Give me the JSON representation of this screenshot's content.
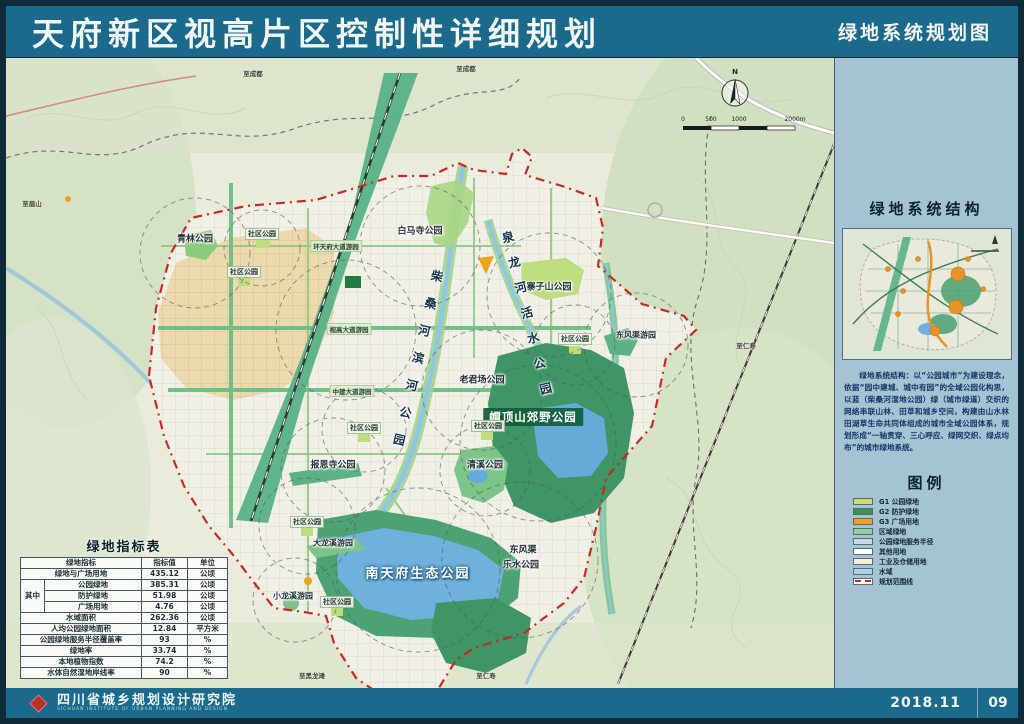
{
  "header": {
    "title": "天府新区视高片区控制性详细规划",
    "subtitle": "绿地系统规划图"
  },
  "map": {
    "compass": "N",
    "scale_ticks": [
      "0",
      "500",
      "1000",
      "2000m"
    ],
    "labels": [
      {
        "text": "青林公园"
      },
      {
        "text": "社区公园"
      },
      {
        "text": "社区公园"
      },
      {
        "text": "白马寺公园"
      },
      {
        "text": "寨子山公园"
      },
      {
        "text": "社区公园"
      },
      {
        "text": "东风渠游园"
      },
      {
        "text": "老君场公园"
      },
      {
        "text": "帽顶山郊野公园"
      },
      {
        "text": "社区公园"
      },
      {
        "text": "社区公园"
      },
      {
        "text": "清溪公园"
      },
      {
        "text": "报恩寺公园"
      },
      {
        "text": "社区公园"
      },
      {
        "text": "大龙溪游园"
      },
      {
        "text": "南天府生态公园"
      },
      {
        "text": "东风渠"
      },
      {
        "text": "乐水公园"
      },
      {
        "text": "小龙溪游园"
      },
      {
        "text": "社区公园"
      },
      {
        "text": "环天府大道游园"
      },
      {
        "text": "视高大道游园"
      },
      {
        "text": "中建大道游园"
      }
    ],
    "vertical_labels": [
      {
        "text": "柴桑河滨河公园"
      },
      {
        "text": "泉龙河活水公园"
      }
    ],
    "edge_labels": [
      {
        "text": "至成都"
      },
      {
        "text": "至成都"
      },
      {
        "text": "至眉山"
      },
      {
        "text": "至仁寿"
      },
      {
        "text": "至黑龙滩"
      },
      {
        "text": "至仁寿"
      }
    ]
  },
  "table": {
    "title": "绿地指标表",
    "headers": [
      "绿地指标",
      "指标值",
      "单位"
    ],
    "group_label": "其中",
    "rows": [
      {
        "name": "绿地与广场用地",
        "value": "435.12",
        "unit": "公顷"
      },
      {
        "name": "公园绿地",
        "value": "385.31",
        "unit": "公顷"
      },
      {
        "name": "防护绿地",
        "value": "51.98",
        "unit": "公顷"
      },
      {
        "name": "广场用地",
        "value": "4.76",
        "unit": "公顷"
      },
      {
        "name": "水域面积",
        "value": "262.36",
        "unit": "公顷"
      },
      {
        "name": "人均公园绿地面积",
        "value": "12.84",
        "unit": "平方米"
      },
      {
        "name": "公园绿地服务半径覆盖率",
        "value": "93",
        "unit": "%"
      },
      {
        "name": "绿地率",
        "value": "33.74",
        "unit": "%"
      },
      {
        "name": "本地植物指数",
        "value": "74.2",
        "unit": "%"
      },
      {
        "name": "水体自然湿地岸线率",
        "value": "90",
        "unit": "%"
      }
    ]
  },
  "panel": {
    "structure_heading": "绿地系统结构",
    "description": "绿地系统结构：以“公园城市”为建设理念，依据“园中建城、城中有园”的全域公园化构思，以蓝（柴桑河湿地公园）绿（城市绿道）交织的网络串联山林、田草和城乡空间，构建由山水林田湖草生命共同体组成的城市全域公园体系，规划形成“一轴贯穿、三心呼应、绿网交织、绿点均布”的城市绿地系统。",
    "legend_heading": "图例",
    "legend": [
      {
        "label": "G1 公园绿地",
        "color": "#c6df6f"
      },
      {
        "label": "G2 防护绿地",
        "color": "#3f9150"
      },
      {
        "label": "G3 广场用地",
        "color": "#f0a11f"
      },
      {
        "label": "区域绿地",
        "color": "#8fd49c"
      },
      {
        "label": "公园绿地服务半径",
        "color": "#c7dbe3"
      },
      {
        "label": "其他用地",
        "color": "#ffffff"
      },
      {
        "label": "工业及仓储用地",
        "color": "#f6f0d9"
      },
      {
        "label": "水域",
        "color": "#a8d3ec"
      },
      {
        "label": "规划范围线",
        "color": "#ffffff"
      }
    ]
  },
  "footer": {
    "org": "四川省城乡规划设计研究院",
    "org_en": "SICHUAN INSTITUTE OF URBAN PLANNING AND DESIGN",
    "date": "2018.11",
    "page": "09"
  }
}
